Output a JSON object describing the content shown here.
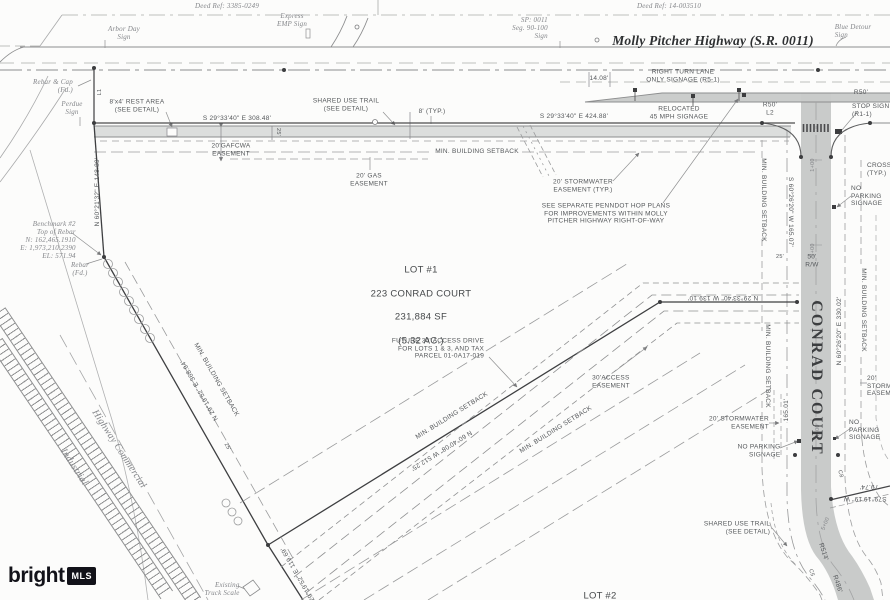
{
  "watermark": {
    "brand": "bright",
    "suffix": "MLS"
  },
  "highway": {
    "name": "Molly Pitcher Highway (S.R. 0011)",
    "deed_ref_left": "Deed Ref: 3385-0249",
    "deed_ref_right": "Deed Ref: 14-003510",
    "arbor_day_sign": "Arbor Day\nSign",
    "express_emp_sign": "Express\nEMP Sign",
    "sp_seg_sign": "SP: 0011\nSeg. 90-100\nSign",
    "blue_detour_sign": "Blue Detour\nSign",
    "right_turn_note": "RIGHT TURN LANE\nONLY SIGNAGE (R5-1)",
    "relocated_note": "RELOCATED\n45 MPH SIGNAGE",
    "dim_1408": "14.08'",
    "r50_l2": "R50'\nL2",
    "r50": "R50'",
    "stop_sign": "STOP SIGN\n(R1-1)",
    "bearing_308": "S 29°33'40\" E    308.48'",
    "bearing_424": "S 29°33'40\" E    424.88'",
    "rest_area": "8'x4' REST AREA\n(SEE DETAIL)",
    "trail_width": "8' (TYP.)",
    "dim_25": "25'"
  },
  "notes": {
    "shared_use_trail": "SHARED USE TRAIL\n(SEE DETAIL)",
    "min_setback": "MIN. BUILDING SETBACK",
    "gafcwa": "20'GAFCWA\nEASEMENT",
    "gas_easement": "20' GAS\nEASEMENT",
    "stormwater_typ": "20' STORMWATER\nEASEMENT (TYP.)",
    "stormwater": "20' STORMWATER\nEASEMENT",
    "no_parking": "NO PARKING\nSIGNAGE",
    "penndot": "SEE SEPARATE PENNDOT HOP PLANS\nFOR IMPROVEMENTS WITHIN MOLLY\nPITCHER HIGHWAY RIGHT-OF-WAY",
    "crosswalk": "CROSS\n(TYP.)"
  },
  "west": {
    "rebar_cap": "Rebar & Cap\n(Fd.)",
    "perdue_sign": "Perdue\nSign",
    "l1": "L1",
    "bearing_nw": "N 60°21'32\" E  148.89'",
    "benchmark": "Benchmark #2\nTop of Rebar\nN: 162,465.1910\nE: 1,973,210.2390\nEL: 571.94",
    "rebar_fd": "Rebar\n(Fd.)",
    "bearing_sw": "N 29°19'52\" E   368.94'",
    "bearing_sw2": "S 29°19'52\" E   119.69'",
    "zone_commercial": "Highway Commercial",
    "zone_industrial": "Industrial",
    "truck_scale": "Existing\nTruck Scale"
  },
  "lot1": {
    "title": "LOT #1",
    "address": "223 CONRAD COURT",
    "area_sf": "231,884 SF",
    "area_ac": "(5.32 AC.)",
    "future_drive": "FUTURE 30' ACCESS DRIVE\nFOR LOTS 1 & 3, AND TAX\nPARCEL 01-0A17-019",
    "access_easement": "30'ACCESS\nEASEMENT",
    "bearing_south": "N 60°40'08\" W   512.25'",
    "bearing_north_seg": "N 29°33'40\" W   139.10'"
  },
  "conrad": {
    "name": "CONRAD COURT",
    "bearing_w": "S 60°26'20\" W  165.07'",
    "bearing_e": "N 60°26'20\" E  330.02'",
    "dim_165": "165.01'",
    "rw": "50'\nR/W",
    "sta_1": "1+00",
    "sta_2": "2+00",
    "sta_4": "4+00",
    "sta_5": "5+00",
    "r514": "R514'",
    "r486": "R486'",
    "c5": "C5",
    "c8": "C8",
    "bearing_79": "S79°19'19\" W",
    "dim_79": "79.74'",
    "lot2": "LOT #2"
  }
}
